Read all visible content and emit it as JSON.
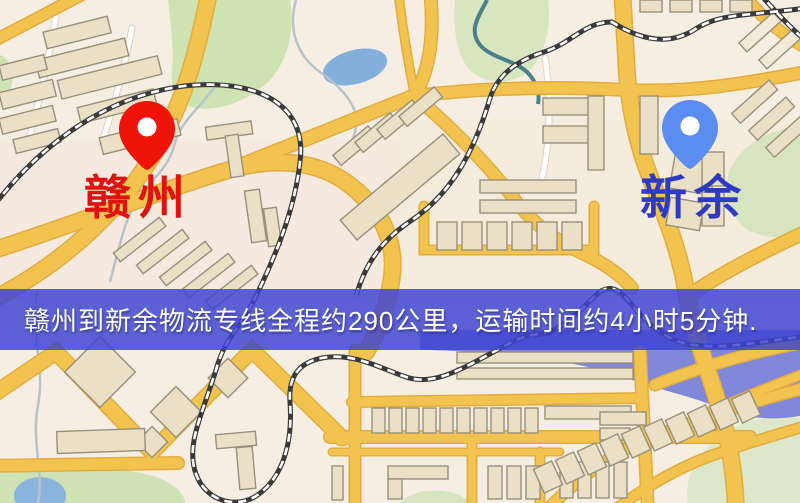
{
  "meta": {
    "type": "logistics-route-map",
    "width": 800,
    "height": 503
  },
  "banner": {
    "text": "赣州到新余物流专线全程约290公里，运输时间约4小时5分钟.",
    "background_color": "#464cc9",
    "text_color": "#ffffff"
  },
  "route": {
    "origin": "赣州",
    "destination": "新余",
    "distance_text": "约290公里",
    "duration_text": "约4小时5分钟"
  },
  "markers": {
    "origin": {
      "label": "赣州",
      "pin_color": "#ee1409",
      "label_color": "#de1310"
    },
    "destination": {
      "label": "新余",
      "pin_color": "#5b8df0",
      "label_color": "#2c3ac4"
    }
  },
  "map_style": {
    "base": "#f6eee2",
    "road": "#f2c34f",
    "road_casing": "#e2ad3f",
    "minor_road": "#ffffff",
    "building_fill": "#ebdfc5",
    "building_stroke": "#98907b",
    "green": "#cfe2b2",
    "green_pale": "#dce8c9",
    "water": "#84afdd",
    "river": "#8187d8",
    "railway": "#3a3a3a",
    "stream": "#b6c3c9",
    "stream_teal": "#49808a"
  }
}
